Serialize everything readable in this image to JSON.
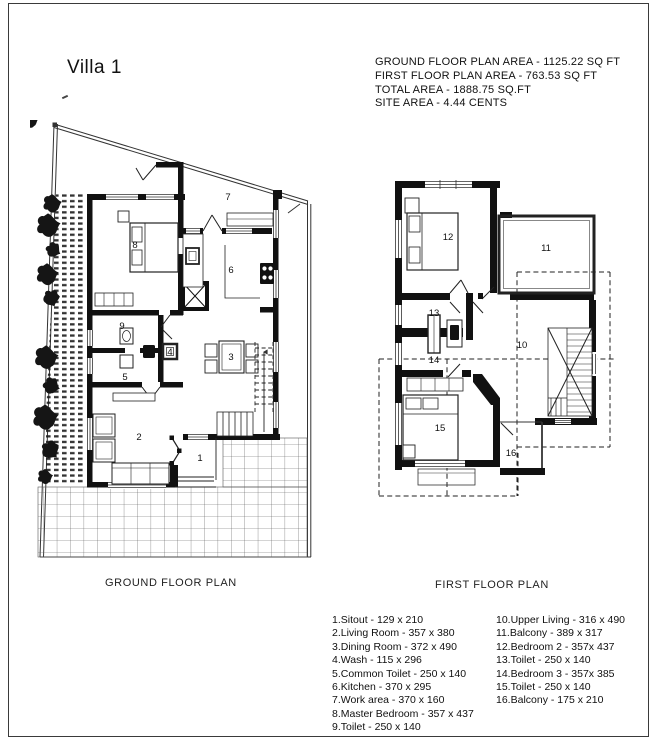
{
  "window": {
    "title": "Villa 1"
  },
  "area_summary": {
    "line1": "GROUND FLOOR PLAN AREA - 1125.22 SQ FT",
    "line2": "FIRST FLOOR PLAN AREA - 763.53 SQ FT",
    "line3": "TOTAL AREA - 1888.75 SQ.FT",
    "line4": "SITE AREA - 4.44 CENTS"
  },
  "plans": {
    "ground": {
      "caption": "GROUND FLOOR PLAN",
      "rooms": [
        "1",
        "2",
        "3",
        "4",
        "5",
        "6",
        "7",
        "8",
        "9"
      ]
    },
    "first": {
      "caption": "FIRST FLOOR PLAN",
      "rooms": [
        "10",
        "11",
        "12",
        "13",
        "14",
        "15",
        "16"
      ]
    }
  },
  "legend": {
    "left": [
      "1.Sitout -  129 x 210",
      "2.Living Room - 357 x 380",
      "3.Dining Room - 372 x 490",
      "4.Wash - 115 x 296",
      "5.Common Toilet - 250 x 140",
      "6.Kitchen - 370 x 295",
      "7.Work area - 370 x 160",
      "8.Master Bedroom - 357 x 437",
      "9.Toilet - 250 x 140"
    ],
    "right": [
      "10.Upper Living - 316 x 490",
      "11.Balcony - 389 x 317",
      "12.Bedroom 2 - 357x 437",
      "13.Toilet - 250 x 140",
      "14.Bedroom 3 - 357x 385",
      "15.Toilet - 250 x 140",
      "16.Balcony - 175 x 210"
    ]
  },
  "colors": {
    "ink": "#1a1a1a",
    "wall": "#111111",
    "background": "#ffffff"
  }
}
